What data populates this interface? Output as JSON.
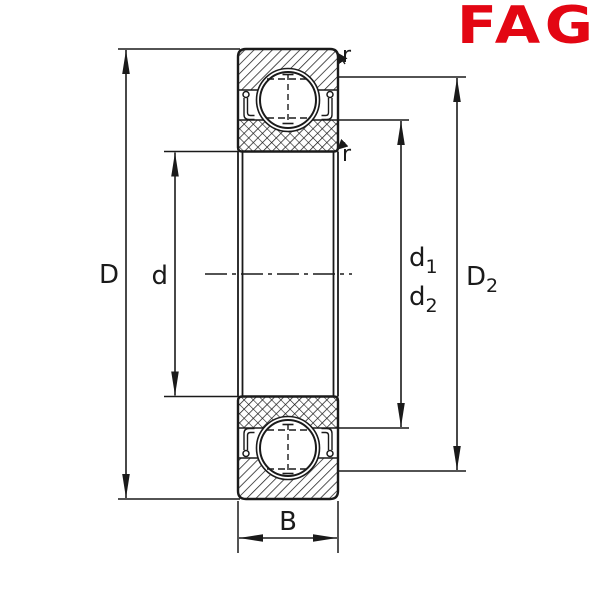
{
  "logo": {
    "text": "FAG",
    "color": "#e30613"
  },
  "labels": {
    "outer_diameter": "D",
    "bore_diameter": "d",
    "d1": {
      "base": "d",
      "sub": "1"
    },
    "d2": {
      "base": "d",
      "sub": "2"
    },
    "D2": {
      "base": "D",
      "sub": "2"
    },
    "width": "B",
    "radius_top": "r",
    "radius_inner": "r"
  },
  "colors": {
    "line": "#1a1a1a",
    "logo": "#e30613",
    "background": "#ffffff"
  }
}
